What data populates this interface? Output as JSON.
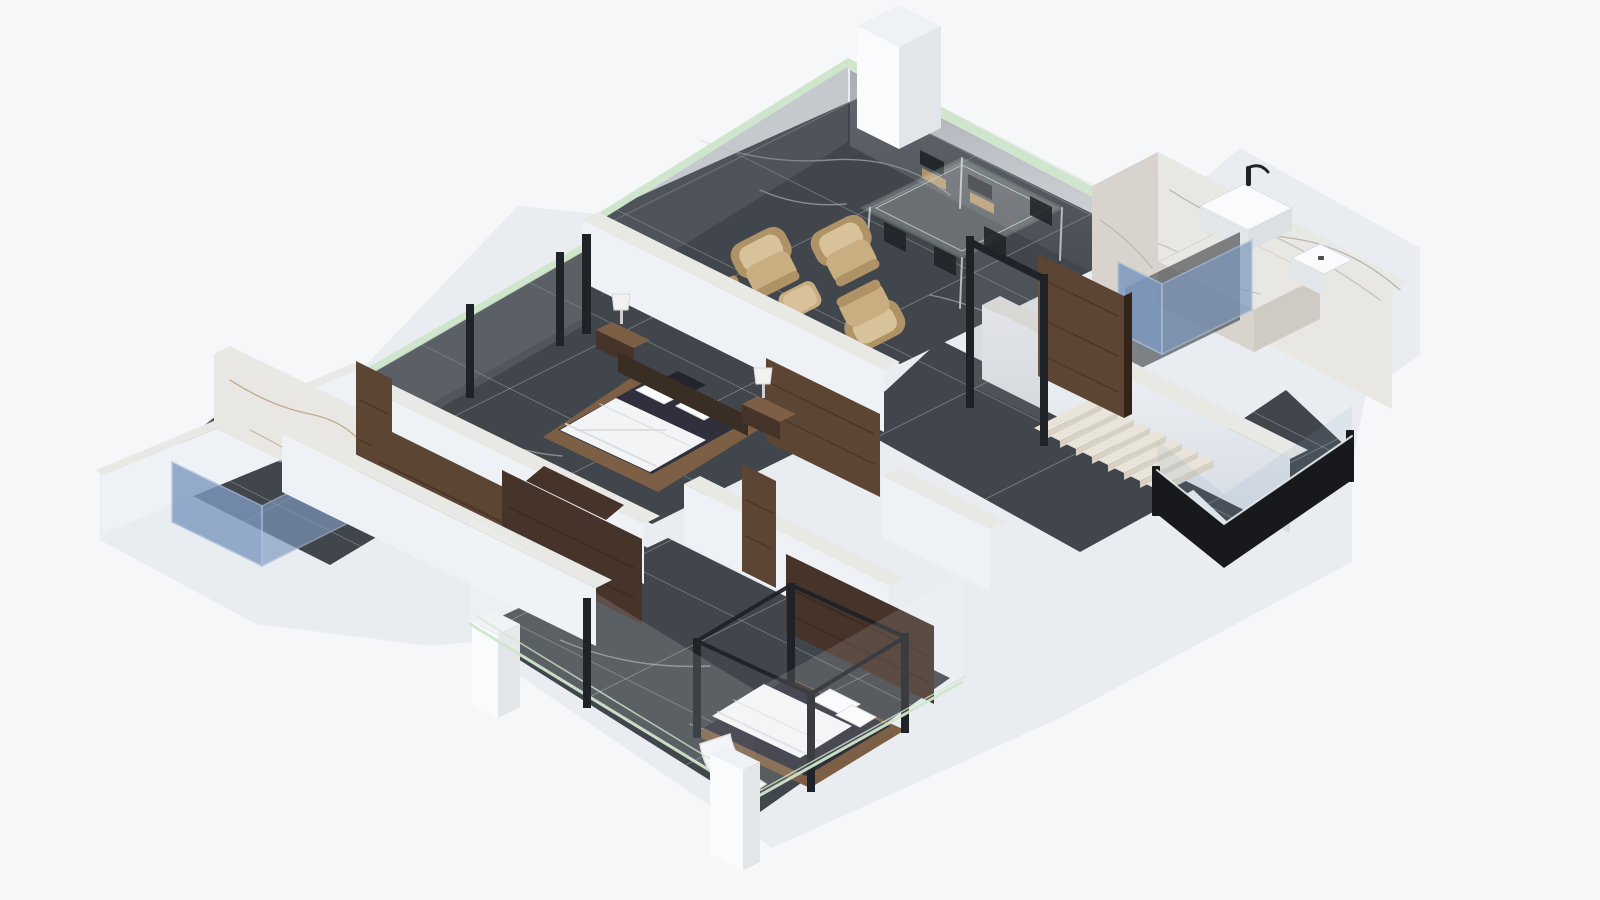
{
  "app": {
    "name": "isometric-floorplan-render",
    "description": "Photoreal 3D isometric cutaway floor plan of an apartment with dark marble tile floors, white cut walls, glass facades, wood doors and furniture. No visible text in the image."
  },
  "colors": {
    "bg": "#f6f7f9",
    "plinth": "#e9edf2",
    "plinthShade": "#dde3ea",
    "floor": "#41464c",
    "floorDeep": "#34383d",
    "grout": "#b9bfc4",
    "wallFace": "#eef1f5",
    "wallShade": "#e2e8ee",
    "wallTop": "#e8e8e5",
    "marble": "#e9e7e3",
    "marbleShade": "#d8d4cd",
    "marbleVein": "#9b948c",
    "goldVein": "#a8824e",
    "wood": "#5d4533",
    "woodDark": "#46332a",
    "woodGrain": "#33241a",
    "woodBase": "#7c5f44",
    "glassGreen": "#cfe6cc",
    "glassTint": "#8d9298",
    "railBlack": "#17191c",
    "frameBlack": "#1f2226",
    "stepTread": "#e9e4da",
    "stepRiser": "#d7d1c4",
    "showerBlue": "#7e99bf",
    "showerBlueLight": "#a9c0d8",
    "navy": "#2f303b",
    "navyDark": "#23242c",
    "duvet": "#f3f4f6",
    "duvetShade": "#d9dade",
    "headboard": "#3a2d24",
    "tan": "#c9ae82",
    "tanLight": "#d8c29a",
    "tanDark": "#b09267",
    "white": "#fafbfc",
    "whiteShade": "#e2e6e9",
    "reflect": "#72777c",
    "glassEdge": "#b7d4c2",
    "lampWhite": "#f1f1f2"
  },
  "scene": {
    "rooms": [
      {
        "name": "living-dining-room"
      },
      {
        "name": "master-bedroom"
      },
      {
        "name": "second-bedroom"
      },
      {
        "name": "wardrobe-corridor"
      },
      {
        "name": "bathroom-left"
      },
      {
        "name": "bathroom-right"
      },
      {
        "name": "hallway"
      },
      {
        "name": "staircase"
      },
      {
        "name": "balcony"
      }
    ],
    "furniture": [
      {
        "name": "glass-dining-table"
      },
      {
        "name": "dining-chairs",
        "count": 6
      },
      {
        "name": "lounge-armchairs",
        "count": 4
      },
      {
        "name": "ottoman"
      },
      {
        "name": "master-double-bed"
      },
      {
        "name": "nightstands",
        "count": 2
      },
      {
        "name": "table-lamps",
        "count": 2
      },
      {
        "name": "second-double-bed-canopy"
      },
      {
        "name": "wardrobe-wood-panels",
        "count": 3
      },
      {
        "name": "wood-interior-doors",
        "count": 4
      },
      {
        "name": "washbasin"
      },
      {
        "name": "faucet"
      },
      {
        "name": "toilet"
      },
      {
        "name": "blue-glass-shower",
        "count": 2
      },
      {
        "name": "glass-balustrade"
      },
      {
        "name": "marble-stairs"
      }
    ]
  }
}
